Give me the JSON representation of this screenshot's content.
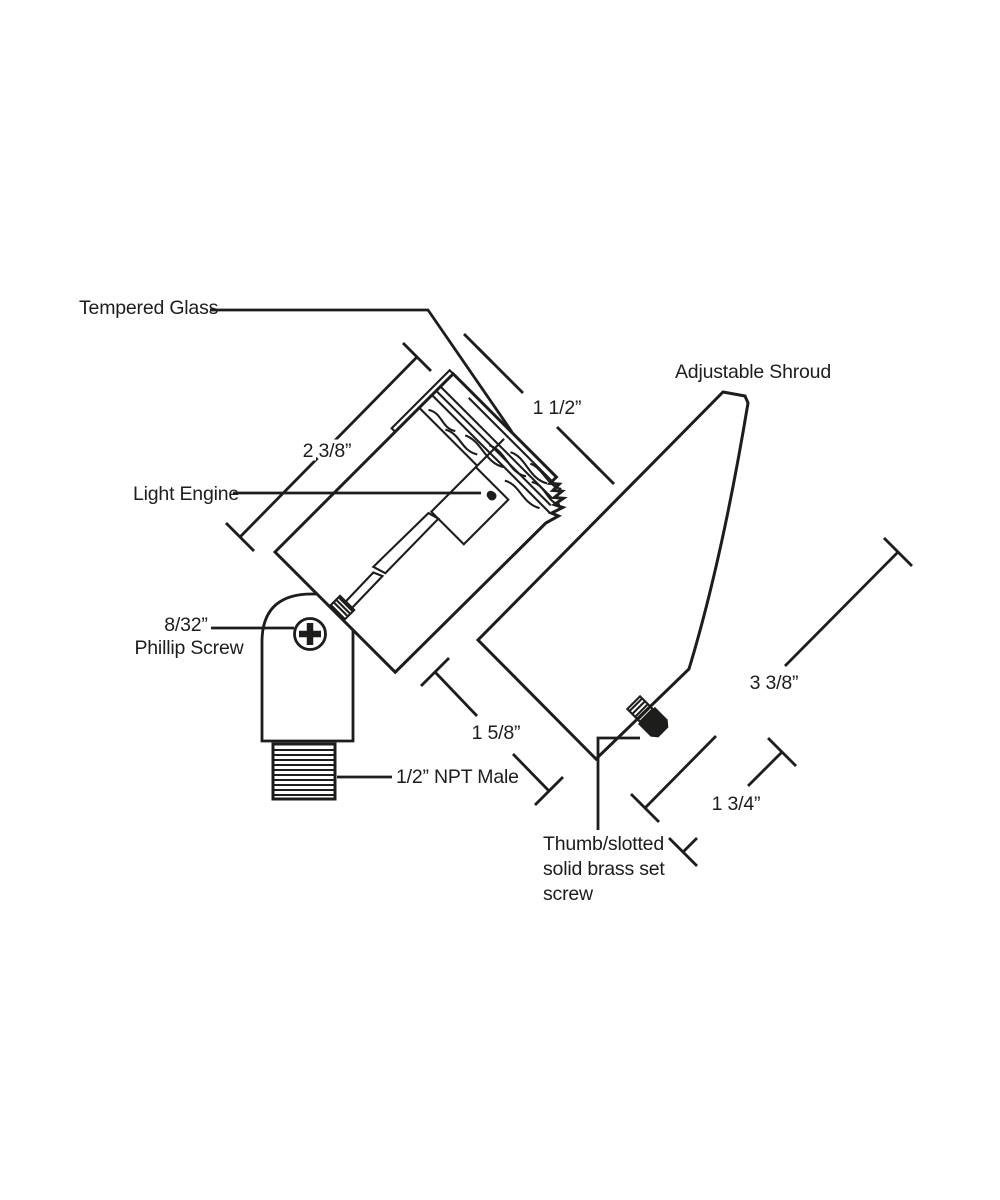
{
  "diagram": {
    "description": "Dimensioned technical line drawing of an adjustable landscape spotlight fixture",
    "labels": {
      "tempered_glass": "Tempered Glass",
      "adjustable_shroud": "Adjustable Shroud",
      "light_engine": "Light Engine",
      "phillip_screw_size": "8/32”",
      "phillip_screw": "Phillip Screw",
      "npt_male": "1/2” NPT Male",
      "set_screw_line1": "Thumb/slotted",
      "set_screw_line2": "solid brass set",
      "set_screw_line3": "screw"
    },
    "dimensions": {
      "bezel_length": "1 1/2”",
      "body_length": "2 3/8”",
      "knuckle_height": "1 5/8”",
      "shroud_length": "3 3/8”",
      "shroud_mouth": "1 3/4”"
    },
    "colors": {
      "line": "#1d1d1b",
      "background": "#ffffff"
    }
  }
}
